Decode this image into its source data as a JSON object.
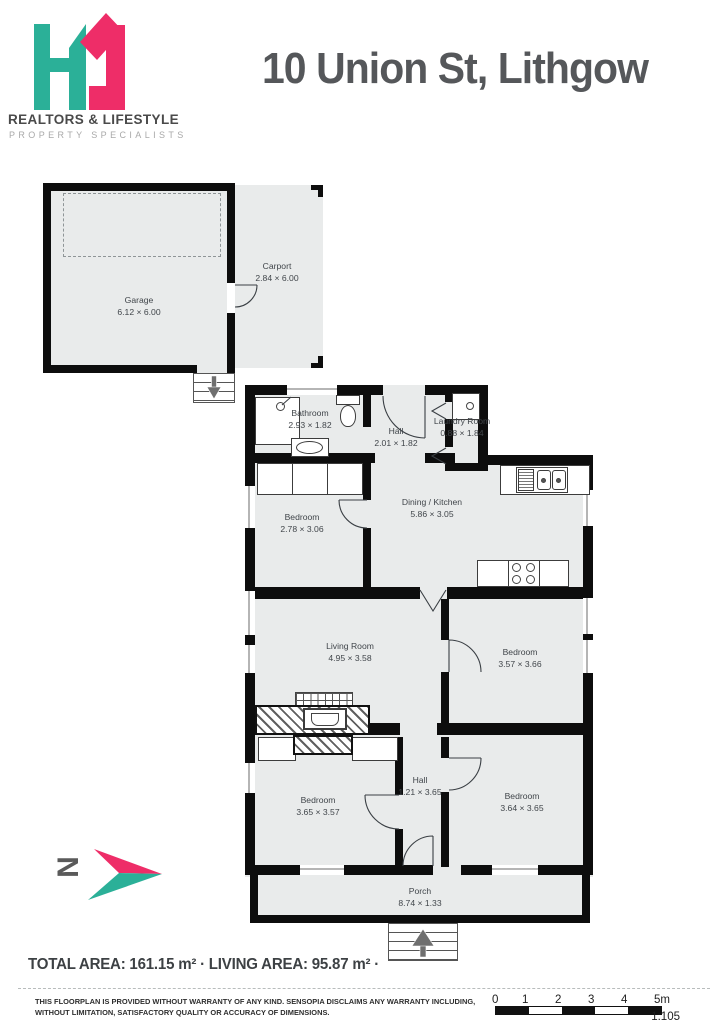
{
  "header": {
    "title": "10 Union St, Lithgow",
    "brand_line1": "REALTORS & LIFESTYLE",
    "brand_line2": "PROPERTY SPECIALISTS"
  },
  "colors": {
    "teal": "#2bb098",
    "pink": "#ee2d68",
    "wall": "#0d0d0d",
    "room_fill": "#e9ebeb",
    "label_text": "#40454a"
  },
  "compass": {
    "label": "N"
  },
  "rooms": [
    {
      "name": "Garage",
      "dims": "6.12 × 6.00"
    },
    {
      "name": "Carport",
      "dims": "2.84 × 6.00"
    },
    {
      "name": "Bathroom",
      "dims": "2.93 × 1.82"
    },
    {
      "name": "Hall",
      "dims": "2.01 × 1.82"
    },
    {
      "name": "Laundry Room",
      "dims": "0.88 × 1.84"
    },
    {
      "name": "Bedroom",
      "dims": "2.78 × 3.06"
    },
    {
      "name": "Dining / Kitchen",
      "dims": "5.86 × 3.05"
    },
    {
      "name": "Living Room",
      "dims": "4.95 × 3.58"
    },
    {
      "name": "Bedroom",
      "dims": "3.57 × 3.66"
    },
    {
      "name": "Bedroom",
      "dims": "3.65 × 3.57"
    },
    {
      "name": "Hall",
      "dims": "1.21 × 3.65"
    },
    {
      "name": "Bedroom",
      "dims": "3.64 × 3.65"
    },
    {
      "name": "Porch",
      "dims": "8.74 × 1.33"
    }
  ],
  "footer": {
    "total_label": "TOTAL AREA:",
    "total_value": "161.15 m²",
    "separator": "·",
    "living_label": "LIVING AREA:",
    "living_value": "95.87 m²",
    "trailing_dot": "·",
    "disclaimer_line1": "THIS FLOORPLAN IS PROVIDED WITHOUT WARRANTY OF ANY KIND. SENSOPIA DISCLAIMS ANY WARRANTY INCLUDING,",
    "disclaimer_line2": "WITHOUT LIMITATION, SATISFACTORY QUALITY OR ACCURACY OF DIMENSIONS.",
    "scale_ticks": [
      "0",
      "1",
      "2",
      "3",
      "4",
      "5m"
    ],
    "scale_ratio": "1:105"
  }
}
